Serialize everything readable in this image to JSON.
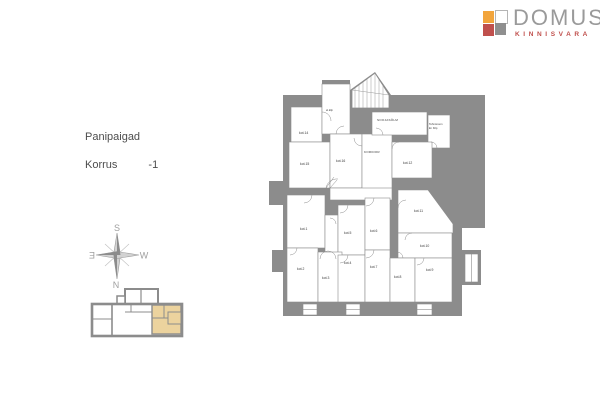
{
  "logo": {
    "name": "DOMUS",
    "subtitle": "KINNISVARA"
  },
  "info": {
    "title": "Panipaigad",
    "floor_label": "Korrus",
    "floor_value": "-1"
  },
  "compass": {
    "s": "S",
    "e": "Ǝ",
    "w": "W",
    "n": "N"
  },
  "plan": {
    "rooms": [
      {
        "label": "kot.1"
      },
      {
        "label": "kot.2"
      },
      {
        "label": "kot.3"
      },
      {
        "label": "kot.4"
      },
      {
        "label": "kot.5"
      },
      {
        "label": "kot.6"
      },
      {
        "label": "kot.7"
      },
      {
        "label": "kot.8"
      },
      {
        "label": "kot.9"
      },
      {
        "label": "kot.10"
      },
      {
        "label": "kot.11"
      },
      {
        "label": "kot.12"
      },
      {
        "label": "kot.14"
      },
      {
        "label": "kot.15"
      },
      {
        "label": "kot.16"
      }
    ],
    "areas": {
      "koridor": "KORIDOR",
      "soojasolm": "SOOJASÕLM",
      "tehnoruum_l1": "Tehnoruum",
      "tehnoruum_l2": "El. Kilp",
      "el_kilp": "el.kilp"
    }
  },
  "colors": {
    "wall_gray": "#8c8c8c",
    "highlight_tan": "#ecd39e",
    "brand_red": "#c0504d",
    "brand_orange": "#f2a53c",
    "brand_gray": "#9a9a9a"
  }
}
